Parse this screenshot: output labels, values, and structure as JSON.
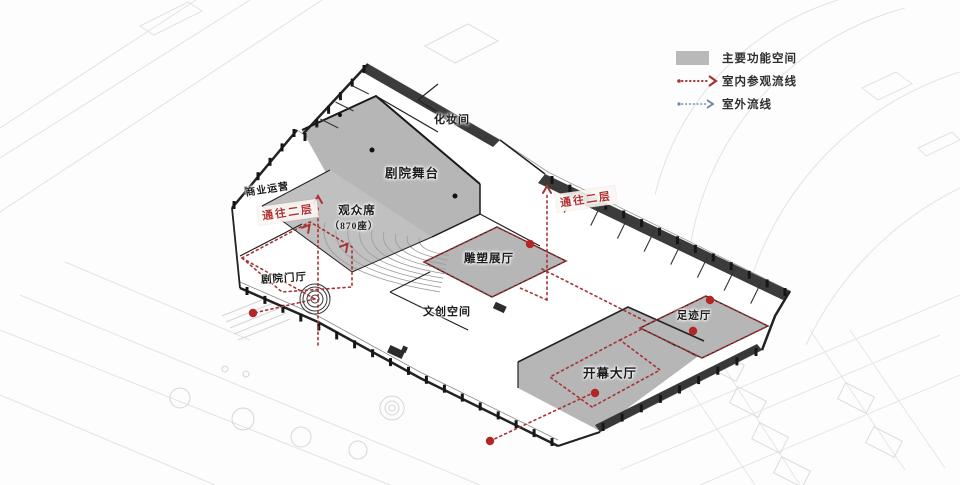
{
  "legend": {
    "main_space_label": "主要功能空间",
    "indoor_route_label": "室内参观流线",
    "outdoor_route_label": "室外流线",
    "colors": {
      "main_space": "#b9b9b9",
      "indoor_route": "#a63434",
      "outdoor_route": "#6c84a8"
    }
  },
  "plan": {
    "labels": [
      {
        "id": "makeup-room-label",
        "text": "化妆间",
        "x": 452,
        "y": 119,
        "size": 11,
        "rotate": 0,
        "red": false
      },
      {
        "id": "theater-stage-label",
        "text": "剧院舞台",
        "x": 412,
        "y": 172,
        "size": 12.5,
        "rotate": 0,
        "red": false
      },
      {
        "id": "auditorium-label",
        "text": "观众席",
        "x": 357,
        "y": 210,
        "size": 11.5,
        "rotate": 0,
        "red": false
      },
      {
        "id": "auditorium-seats-label",
        "text": "（870座）",
        "x": 354,
        "y": 225,
        "size": 9.5,
        "rotate": 0,
        "red": false
      },
      {
        "id": "commercial-operation-label",
        "text": "商业运营",
        "x": 267,
        "y": 188,
        "size": 10,
        "rotate": -9,
        "red": false
      },
      {
        "id": "to-second-floor-left-label",
        "text": "通往二层",
        "x": 288,
        "y": 212,
        "size": 11,
        "rotate": -8,
        "red": true
      },
      {
        "id": "theater-lobby-label",
        "text": "剧院门厅",
        "x": 284,
        "y": 278,
        "size": 10.5,
        "rotate": -4,
        "red": false
      },
      {
        "id": "sculpture-gallery-label",
        "text": "雕塑展厅",
        "x": 489,
        "y": 258,
        "size": 11.5,
        "rotate": 0,
        "red": false
      },
      {
        "id": "cultural-creative-space-label",
        "text": "文创空间",
        "x": 447,
        "y": 311,
        "size": 11,
        "rotate": 0,
        "red": false
      },
      {
        "id": "to-second-floor-right-label",
        "text": "通往二层",
        "x": 586,
        "y": 199,
        "size": 11,
        "rotate": -8,
        "red": true
      },
      {
        "id": "footprint-hall-label",
        "text": "足迹厅",
        "x": 694,
        "y": 315,
        "size": 10.5,
        "rotate": 0,
        "red": false
      },
      {
        "id": "opening-hall-label",
        "text": "开幕大厅",
        "x": 610,
        "y": 372,
        "size": 12.5,
        "rotate": 0,
        "red": false
      }
    ]
  }
}
